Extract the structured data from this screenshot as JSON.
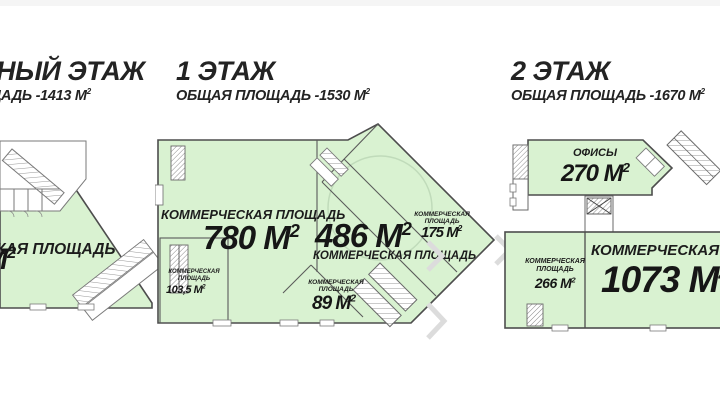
{
  "colors": {
    "plan_fill": "#d9f2d1",
    "plan_stroke": "#4d4d4d",
    "wall_light": "#7a7a7a",
    "hatch": "#979797",
    "text": "#1c1c1c",
    "watermark": "#dcdcdc",
    "top_strip": "#f5f5f5"
  },
  "floors": [
    {
      "title": "НЫЙ ЭТАЖ",
      "subtitle": "ЩАДЬ -1413 М",
      "subtitle_sup": "2",
      "rooms": [
        {
          "label": "КАЯ ПЛОЩАДЬ",
          "area": "М",
          "sup": "2"
        }
      ]
    },
    {
      "title": "1 ЭТАЖ",
      "subtitle": "ОБЩАЯ ПЛОЩАДЬ -1530 М",
      "subtitle_sup": "2",
      "rooms": [
        {
          "label": "КОММЕРЧЕСКАЯ ПЛОЩАДЬ",
          "area": "780 М",
          "sup": "2"
        },
        {
          "label": "КОММЕРЧЕСКАЯ ПЛОЩАДЬ",
          "area": "486 М",
          "sup": "2"
        },
        {
          "label": "КОММЕРЧЕСКАЯ ПЛОЩАДЬ",
          "area": "175 М",
          "sup": "2"
        },
        {
          "label": "КОММЕРЧЕСКАЯ ПЛОЩАДЬ",
          "area": "89 М",
          "sup": "2"
        },
        {
          "label": "КОММЕРЧЕСКАЯ ПЛОЩАДЬ",
          "area": "103,5 М",
          "sup": "2"
        }
      ]
    },
    {
      "title": "2 ЭТАЖ",
      "subtitle": "ОБЩАЯ ПЛОЩАДЬ -1670 М",
      "subtitle_sup": "2",
      "rooms": [
        {
          "label": "ОФИСЫ",
          "area": "270 М",
          "sup": "2"
        },
        {
          "label": "КОММЕРЧЕСКАЯ ПЛОЩАДЬ",
          "area": "266 М",
          "sup": "2"
        },
        {
          "label": "КОММЕРЧЕСКАЯ ПЛОЩАДЬ",
          "area": "1073 М",
          "sup": "2"
        }
      ]
    }
  ]
}
